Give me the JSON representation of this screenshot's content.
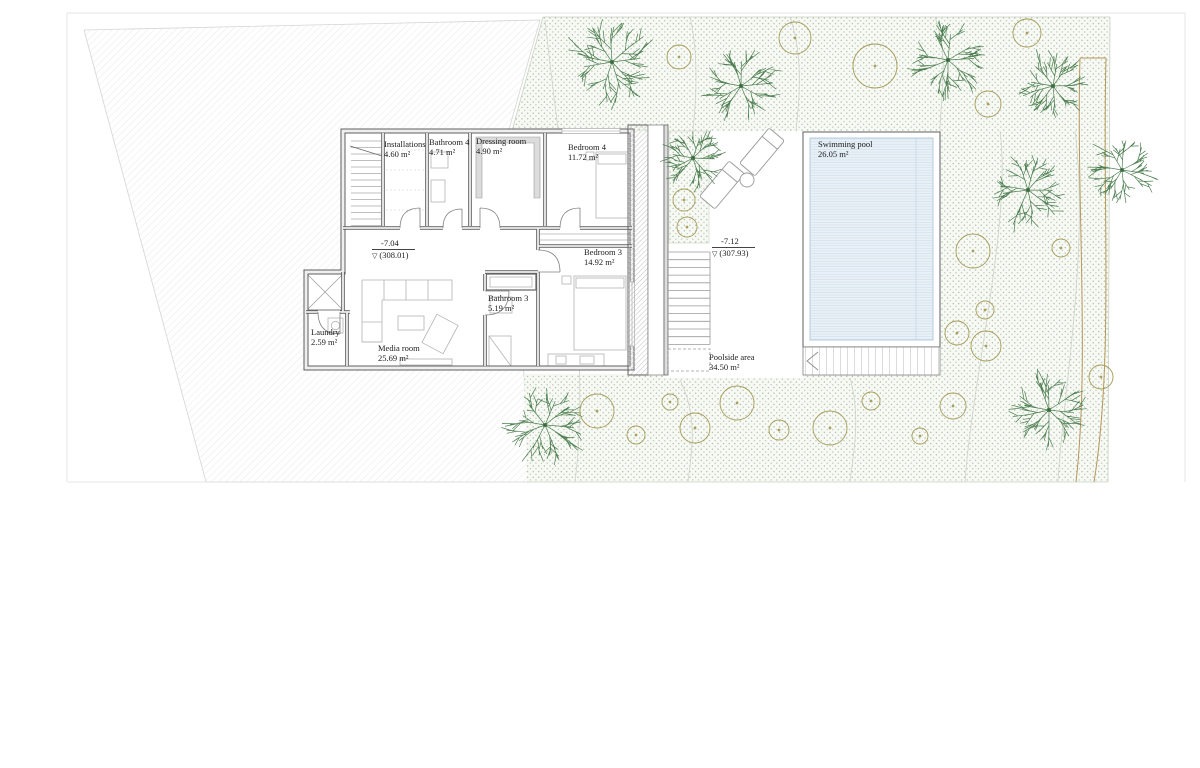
{
  "drawing": {
    "rooms": [
      {
        "id": "installations",
        "label": "Installations",
        "area": "4.60 m²"
      },
      {
        "id": "bathroom-4",
        "label": "Bathroom 4",
        "area": "4.71 m²"
      },
      {
        "id": "dressing-room",
        "label": "Dressing room",
        "area": "4.90 m²"
      },
      {
        "id": "bedroom-4",
        "label": "Bedroom 4",
        "area": "11.72 m²"
      },
      {
        "id": "bedroom-3",
        "label": "Bedroom 3",
        "area": "14.92 m²"
      },
      {
        "id": "bathroom-3",
        "label": "Bathroom 3",
        "area": "5.19 m²"
      },
      {
        "id": "laundry",
        "label": "Laundry",
        "area": "2.59 m²"
      },
      {
        "id": "media-room",
        "label": "Media room",
        "area": "25.69 m²"
      },
      {
        "id": "swimming-pool",
        "label": "Swimming pool",
        "area": "26.05 m²"
      },
      {
        "id": "poolside-area",
        "label": "Poolside area",
        "area": "34.50 m²"
      }
    ],
    "levels": [
      {
        "value": "-7.04",
        "datum": "(308.01)"
      },
      {
        "value": "-7.12",
        "datum": "(307.93)"
      }
    ]
  },
  "colors": {
    "tree": "#4e7f52",
    "tree_center": "#3c6a40",
    "shrub": "#a79b58",
    "dots": "#a3b29b",
    "water_bg": "#e9f1f7",
    "water_line": "#cddeec",
    "path_line": "#b5975a",
    "hatch_line": "#dedede",
    "wall_dark": "#5f5f5f",
    "wall_light": "#efefef"
  },
  "site": {
    "trees": [
      {
        "x": 612,
        "y": 62,
        "r": 46
      },
      {
        "x": 741,
        "y": 86,
        "r": 40
      },
      {
        "x": 948,
        "y": 60,
        "r": 42
      },
      {
        "x": 1053,
        "y": 86,
        "r": 36
      },
      {
        "x": 1028,
        "y": 190,
        "r": 40
      },
      {
        "x": 693,
        "y": 158,
        "r": 33
      },
      {
        "x": 545,
        "y": 425,
        "r": 42
      },
      {
        "x": 1049,
        "y": 410,
        "r": 40
      },
      {
        "x": 1122,
        "y": 170,
        "r": 36
      }
    ],
    "shrubs": [
      {
        "x": 679,
        "y": 57,
        "r": 12
      },
      {
        "x": 795,
        "y": 38,
        "r": 16
      },
      {
        "x": 875,
        "y": 66,
        "r": 22
      },
      {
        "x": 1027,
        "y": 33,
        "r": 14
      },
      {
        "x": 988,
        "y": 104,
        "r": 13
      },
      {
        "x": 973,
        "y": 251,
        "r": 17
      },
      {
        "x": 1061,
        "y": 248,
        "r": 9
      },
      {
        "x": 985,
        "y": 310,
        "r": 9
      },
      {
        "x": 957,
        "y": 333,
        "r": 12
      },
      {
        "x": 986,
        "y": 346,
        "r": 15
      },
      {
        "x": 953,
        "y": 406,
        "r": 13
      },
      {
        "x": 597,
        "y": 411,
        "r": 17
      },
      {
        "x": 636,
        "y": 435,
        "r": 9
      },
      {
        "x": 670,
        "y": 402,
        "r": 8
      },
      {
        "x": 695,
        "y": 428,
        "r": 15
      },
      {
        "x": 737,
        "y": 403,
        "r": 17
      },
      {
        "x": 779,
        "y": 430,
        "r": 10
      },
      {
        "x": 830,
        "y": 428,
        "r": 17
      },
      {
        "x": 871,
        "y": 401,
        "r": 9
      },
      {
        "x": 920,
        "y": 436,
        "r": 8
      },
      {
        "x": 1101,
        "y": 377,
        "r": 12
      },
      {
        "x": 684,
        "y": 200,
        "r": 11
      },
      {
        "x": 687,
        "y": 227,
        "r": 10
      }
    ]
  }
}
